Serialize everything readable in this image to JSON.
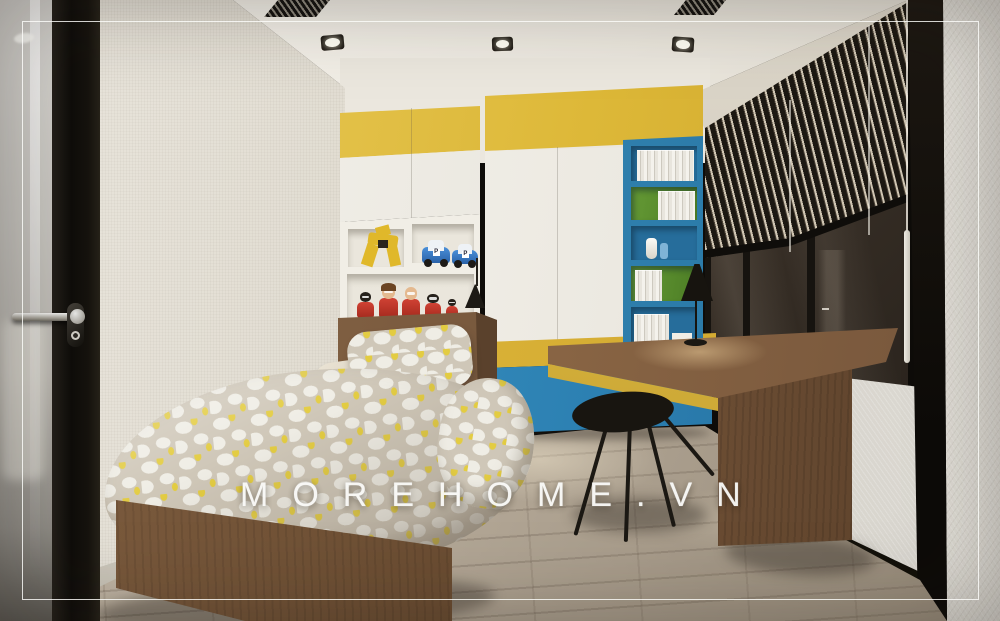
{
  "watermark": {
    "text": "MOREHOME.VN"
  },
  "scene": {
    "type": "3d-interior-render",
    "room": "kids bedroom with study corner",
    "objects": [
      "glass-door",
      "door-handle",
      "left-wall",
      "ceiling",
      "ceiling-downlights",
      "ceiling-vents",
      "overhead-cabinet",
      "tall-wardrobe",
      "toy-shelf",
      "toy-robot",
      "toy-police-cars",
      "toy-red-figures",
      "blue-bookshelf",
      "books",
      "vases",
      "wall-lamp",
      "single-bed",
      "wood-headboard",
      "patterned-duvet",
      "pillows",
      "wood-bed-base",
      "study-desk",
      "desk-lamp",
      "black-chair",
      "window-wall",
      "venetian-blinds",
      "blind-cords",
      "window-sill-panel",
      "corner-post",
      "right-wall",
      "wood-floor",
      "white-inner-border",
      "watermark"
    ]
  },
  "colors": {
    "accent-yellow": "#ddb838",
    "yellow-deep": "#c79f28",
    "accent-blue": "#2f86b8",
    "blue-deep": "#1f6793",
    "shelf-green": "#5a8a2e",
    "wood": "#8a6747",
    "wood-dark": "#5f452e",
    "wall-left": "#ded9ce",
    "ceiling": "#f4f1ea",
    "back-wall": "#ebe7de",
    "right-wall": "#d8d5ce",
    "floor-wood": "#b4a899",
    "glass-dark": "#3b342d",
    "frame-black": "#16130f",
    "white-door": "#f4f2ec",
    "toy-red": "#c23529",
    "duvet-grey": "#cfc7b8",
    "duvet-base": "#efede5",
    "watermark-white": "#fafaf8"
  }
}
